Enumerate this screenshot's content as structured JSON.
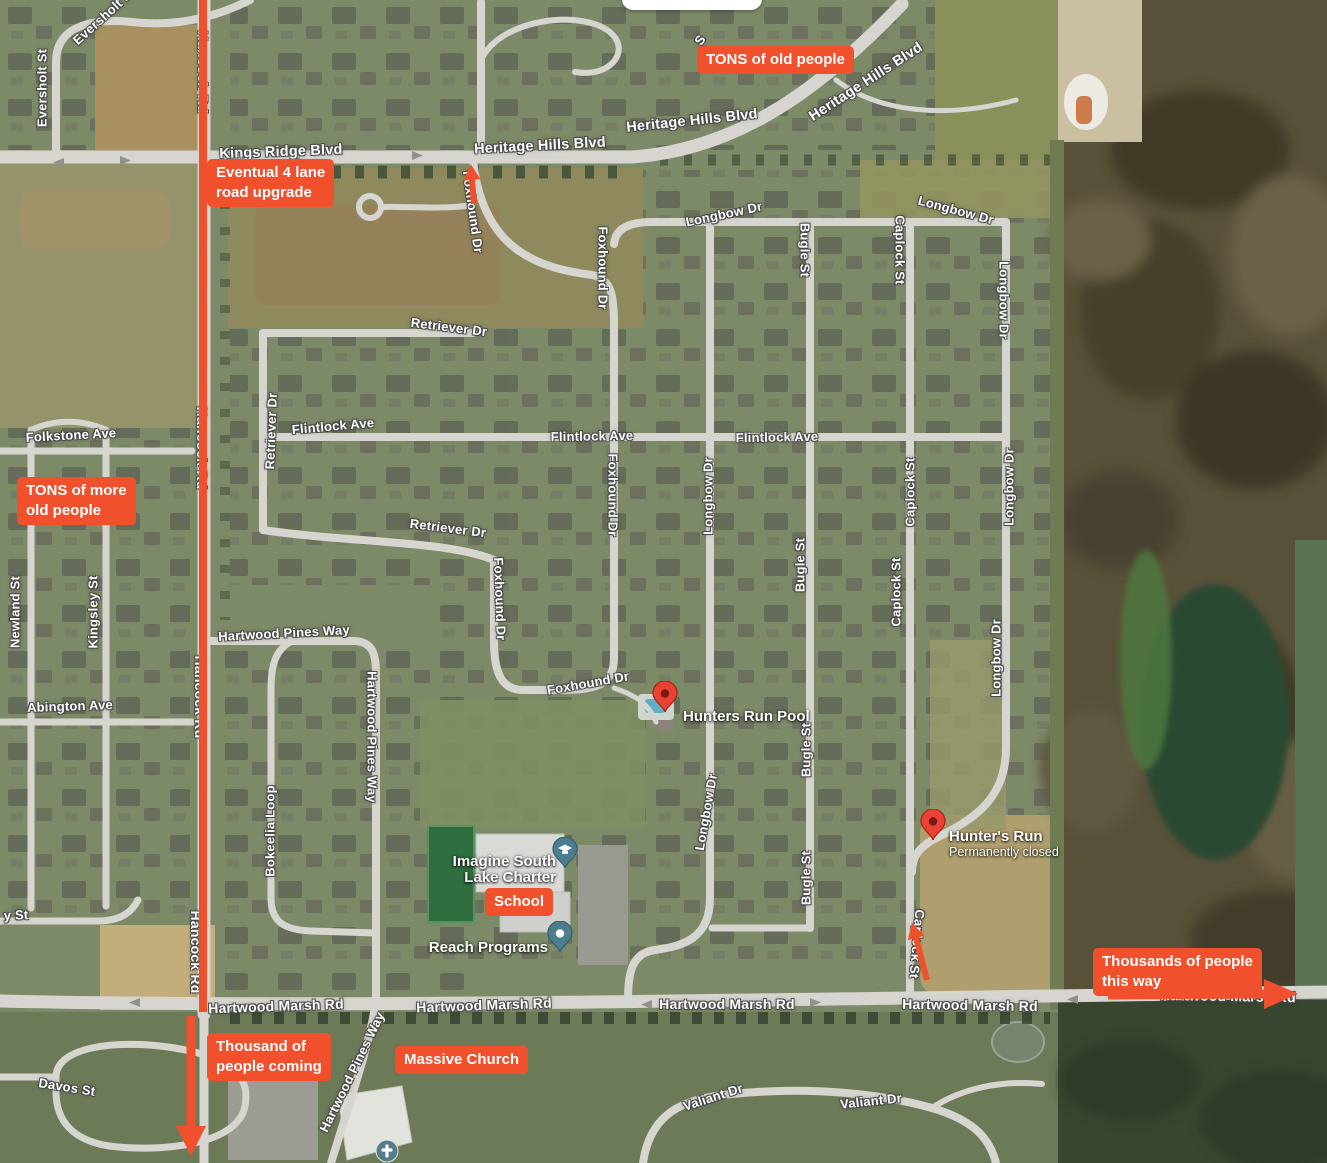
{
  "colors": {
    "annotation": "#F1502C",
    "pin_red": "#EA4335",
    "pin_teal": "#4D7E8F"
  },
  "ui": {
    "top_pill": ""
  },
  "map": {
    "street_labels": [
      {
        "t": "Eversholt St",
        "x": 104,
        "y": 16,
        "r": -42,
        "s": 13
      },
      {
        "t": "Eversholt St",
        "x": 42,
        "y": 88,
        "r": -90,
        "s": 13
      },
      {
        "t": "Kings Ridge Blvd",
        "x": 281,
        "y": 152,
        "r": -2,
        "s": 14.5
      },
      {
        "t": "Heritage Hills Blvd",
        "x": 540,
        "y": 146,
        "r": -3,
        "s": 14.5
      },
      {
        "t": "Heritage Hills Blvd",
        "x": 692,
        "y": 121,
        "r": -6,
        "s": 14.5
      },
      {
        "t": "Heritage Hills Blvd",
        "x": 866,
        "y": 82,
        "r": -33,
        "s": 14.5
      },
      {
        "t": "Hancock Rd",
        "x": 203,
        "y": 72,
        "r": 90,
        "s": 14
      },
      {
        "t": "Hancock Rd",
        "x": 202,
        "y": 448,
        "r": 90,
        "s": 14
      },
      {
        "t": "Hancock Rd",
        "x": 200,
        "y": 697,
        "r": 90,
        "s": 14
      },
      {
        "t": "Hancock Rd",
        "x": 196,
        "y": 952,
        "r": 90,
        "s": 14
      },
      {
        "t": "S",
        "x": 700,
        "y": 40,
        "r": -55,
        "s": 13
      },
      {
        "t": "Longbow Dr",
        "x": 724,
        "y": 214,
        "r": -12,
        "s": 13
      },
      {
        "t": "Longbow Dr",
        "x": 956,
        "y": 210,
        "r": 15,
        "s": 13
      },
      {
        "t": "Longbow Dr",
        "x": 1004,
        "y": 300,
        "r": 90,
        "s": 13
      },
      {
        "t": "Longbow Dr",
        "x": 1009,
        "y": 487,
        "r": -90,
        "s": 13
      },
      {
        "t": "Longbow Dr",
        "x": 996,
        "y": 658,
        "r": -90,
        "s": 13
      },
      {
        "t": "Longbow Dr",
        "x": 708,
        "y": 496,
        "r": -90,
        "s": 13
      },
      {
        "t": "Longbow Dr",
        "x": 706,
        "y": 812,
        "r": -80,
        "s": 13
      },
      {
        "t": "Foxhound Dr",
        "x": 473,
        "y": 212,
        "r": 82,
        "s": 13
      },
      {
        "t": "Foxhound Dr",
        "x": 603,
        "y": 268,
        "r": 90,
        "s": 13
      },
      {
        "t": "Foxhound Dr",
        "x": 613,
        "y": 495,
        "r": 90,
        "s": 13
      },
      {
        "t": "Foxhound Dr",
        "x": 500,
        "y": 599,
        "r": 88,
        "s": 13
      },
      {
        "t": "Foxhound Dr",
        "x": 588,
        "y": 683,
        "r": -10,
        "s": 13
      },
      {
        "t": "Retriever Dr",
        "x": 449,
        "y": 327,
        "r": 7,
        "s": 13
      },
      {
        "t": "Retriever Dr",
        "x": 271,
        "y": 431,
        "r": -88,
        "s": 13
      },
      {
        "t": "Retriever Dr",
        "x": 448,
        "y": 528,
        "r": 7,
        "s": 13
      },
      {
        "t": "Flintlock Ave",
        "x": 333,
        "y": 426,
        "r": -5,
        "s": 13
      },
      {
        "t": "Flintlock Ave",
        "x": 592,
        "y": 436,
        "r": -1,
        "s": 13
      },
      {
        "t": "Flintlock Ave",
        "x": 777,
        "y": 437,
        "r": -1,
        "s": 13
      },
      {
        "t": "Bugle St",
        "x": 805,
        "y": 250,
        "r": 90,
        "s": 13
      },
      {
        "t": "Bugle St",
        "x": 800,
        "y": 565,
        "r": -90,
        "s": 13
      },
      {
        "t": "Bugle St",
        "x": 806,
        "y": 750,
        "r": -90,
        "s": 13
      },
      {
        "t": "Bugle St",
        "x": 806,
        "y": 878,
        "r": -90,
        "s": 13
      },
      {
        "t": "Caplock St",
        "x": 900,
        "y": 250,
        "r": 90,
        "s": 13
      },
      {
        "t": "Caplock St",
        "x": 910,
        "y": 492,
        "r": -90,
        "s": 13
      },
      {
        "t": "Caplock St",
        "x": 896,
        "y": 592,
        "r": -90,
        "s": 13
      },
      {
        "t": "Caplock St",
        "x": 917,
        "y": 944,
        "r": 95,
        "s": 13
      },
      {
        "t": "Hartwood Pines Way",
        "x": 284,
        "y": 633,
        "r": -3,
        "s": 13
      },
      {
        "t": "Hartwood Pines Way",
        "x": 372,
        "y": 737,
        "r": 90,
        "s": 13
      },
      {
        "t": "Hartwood Pines Way",
        "x": 352,
        "y": 1072,
        "r": -64,
        "s": 13
      },
      {
        "t": "Bokeelia Loop",
        "x": 270,
        "y": 831,
        "r": -90,
        "s": 13
      },
      {
        "t": "Folkstone Ave",
        "x": 71,
        "y": 435,
        "r": -3,
        "s": 13
      },
      {
        "t": "Newland St",
        "x": 15,
        "y": 612,
        "r": -90,
        "s": 13
      },
      {
        "t": "Kingsley St",
        "x": 93,
        "y": 612,
        "r": -90,
        "s": 13
      },
      {
        "t": "Abington Ave",
        "x": 70,
        "y": 706,
        "r": -2,
        "s": 13
      },
      {
        "t": "y St",
        "x": 16,
        "y": 915,
        "r": -2,
        "s": 13
      },
      {
        "t": "Davos St",
        "x": 67,
        "y": 1087,
        "r": 9,
        "s": 13
      },
      {
        "t": "Hartwood Marsh Rd",
        "x": 276,
        "y": 1006,
        "r": -2,
        "s": 14
      },
      {
        "t": "Hartwood Marsh Rd",
        "x": 484,
        "y": 1005,
        "r": -2,
        "s": 14
      },
      {
        "t": "Hartwood Marsh Rd",
        "x": 727,
        "y": 1004,
        "r": 0,
        "s": 14
      },
      {
        "t": "Hartwood Marsh Rd",
        "x": 970,
        "y": 1005,
        "r": 1,
        "s": 14
      },
      {
        "t": "Hartwood Marsh Rd",
        "x": 1228,
        "y": 996,
        "r": 1,
        "s": 14
      },
      {
        "t": "Valiant Dr",
        "x": 713,
        "y": 1097,
        "r": -18,
        "s": 13
      },
      {
        "t": "Valiant Dr",
        "x": 871,
        "y": 1101,
        "r": -6,
        "s": 13
      }
    ],
    "pois": [
      {
        "id": "hunters-run-pool",
        "type": "red-pin",
        "px": 665,
        "py": 712,
        "side": "right",
        "lx": 683,
        "ly": 717,
        "lines": [
          "Hunters Run Pool"
        ],
        "sub": ""
      },
      {
        "id": "hunters-run-closed",
        "type": "red-pin",
        "px": 933,
        "py": 840,
        "side": "right",
        "lx": 949,
        "ly": 844,
        "lines": [
          "Hunter's Run"
        ],
        "sub": "Permanently closed"
      },
      {
        "id": "imagine-south-lake-charter",
        "type": "school-pin",
        "px": 565,
        "py": 868,
        "side": "left",
        "lx": 556,
        "ly": 870,
        "lines": [
          "Imagine South",
          "Lake Charter"
        ],
        "sub": ""
      },
      {
        "id": "reach-programs",
        "type": "dot-pin",
        "px": 560,
        "py": 952,
        "side": "left",
        "lx": 548,
        "ly": 948,
        "lines": [
          "Reach Programs"
        ],
        "sub": ""
      },
      {
        "id": "church-place",
        "type": "church-icon",
        "px": 387,
        "py": 1151,
        "side": "none",
        "lx": 0,
        "ly": 0,
        "lines": [],
        "sub": ""
      }
    ]
  },
  "annotations": {
    "badges": [
      {
        "id": "tons-of-old-people",
        "x": 697,
        "y": 46,
        "lines": [
          "TONS of old people"
        ]
      },
      {
        "id": "eventual-4-lane-road-upgrade",
        "x": 207,
        "y": 159,
        "lines": [
          "Eventual 4 lane",
          "road upgrade"
        ]
      },
      {
        "id": "tons-of-more-old-people",
        "x": 17,
        "y": 477,
        "lines": [
          "TONS of more",
          "old people"
        ]
      },
      {
        "id": "school",
        "x": 485,
        "y": 888,
        "lines": [
          "School"
        ]
      },
      {
        "id": "massive-church",
        "x": 395,
        "y": 1046,
        "lines": [
          "Massive Church"
        ]
      },
      {
        "id": "thousands-of-people-this-way",
        "x": 1093,
        "y": 948,
        "lines": [
          "Thousands of people",
          "this way"
        ]
      },
      {
        "id": "thousand-of-people-coming",
        "x": 207,
        "y": 1033,
        "lines": [
          "Thousand of",
          "people coming"
        ]
      }
    ],
    "arrows": [
      {
        "id": "hancock-route-line",
        "x1": 203,
        "y1": -4,
        "x2": 203,
        "y2": 1012,
        "w": 8,
        "head": 0,
        "hw": 0
      },
      {
        "id": "hancock-exit-arrow",
        "x1": 191,
        "y1": 1016,
        "x2": 191,
        "y2": 1126,
        "w": 9,
        "head": 30,
        "hw": 30
      },
      {
        "id": "foxhound-entry-arrow",
        "x1": 474,
        "y1": 204,
        "x2": 472,
        "y2": 180,
        "w": 6,
        "head": 16,
        "hw": 17
      },
      {
        "id": "caplock-entry-arrow",
        "x1": 927,
        "y1": 980,
        "x2": 916,
        "y2": 938,
        "w": 6,
        "head": 16,
        "hw": 17
      },
      {
        "id": "hartwood-east-arrow",
        "x1": 1108,
        "y1": 995,
        "x2": 1264,
        "y2": 994,
        "w": 9,
        "head": 34,
        "hw": 30
      }
    ]
  }
}
